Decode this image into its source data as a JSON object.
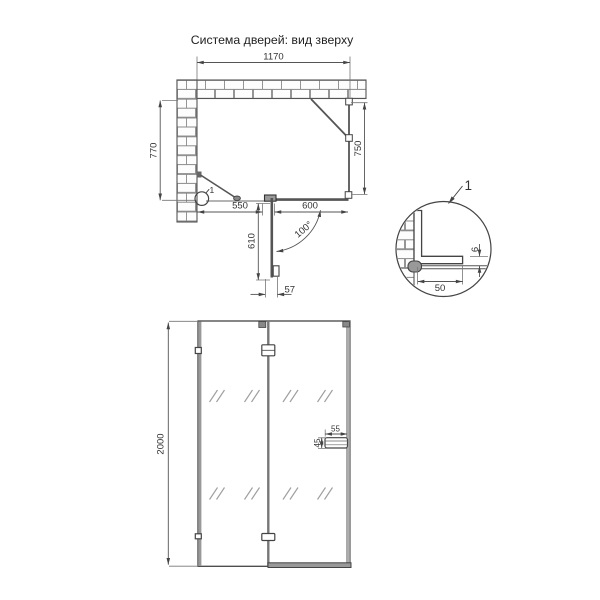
{
  "title": "Система дверей: вид зверху",
  "colors": {
    "line": "#4a4a4a",
    "dimension": "#555555",
    "profile_gray": "#8f8f8f",
    "text": "#333333",
    "background": "#ffffff"
  },
  "top_view": {
    "dim_width_top": "1170",
    "dim_depth_left": "770",
    "dim_side_panel": "750",
    "dim_panel_left": "550",
    "dim_panel_right": "600",
    "dim_door_width": "610",
    "dim_door_edge": "57",
    "door_opening_angle": "100°",
    "callout_label": "1"
  },
  "detail_view": {
    "callout_label": "1",
    "dim_profile_depth": "50",
    "dim_glass_gap": "6"
  },
  "front_view": {
    "dim_height": "2000",
    "dim_handle_width": "55",
    "dim_handle_height": "45"
  }
}
